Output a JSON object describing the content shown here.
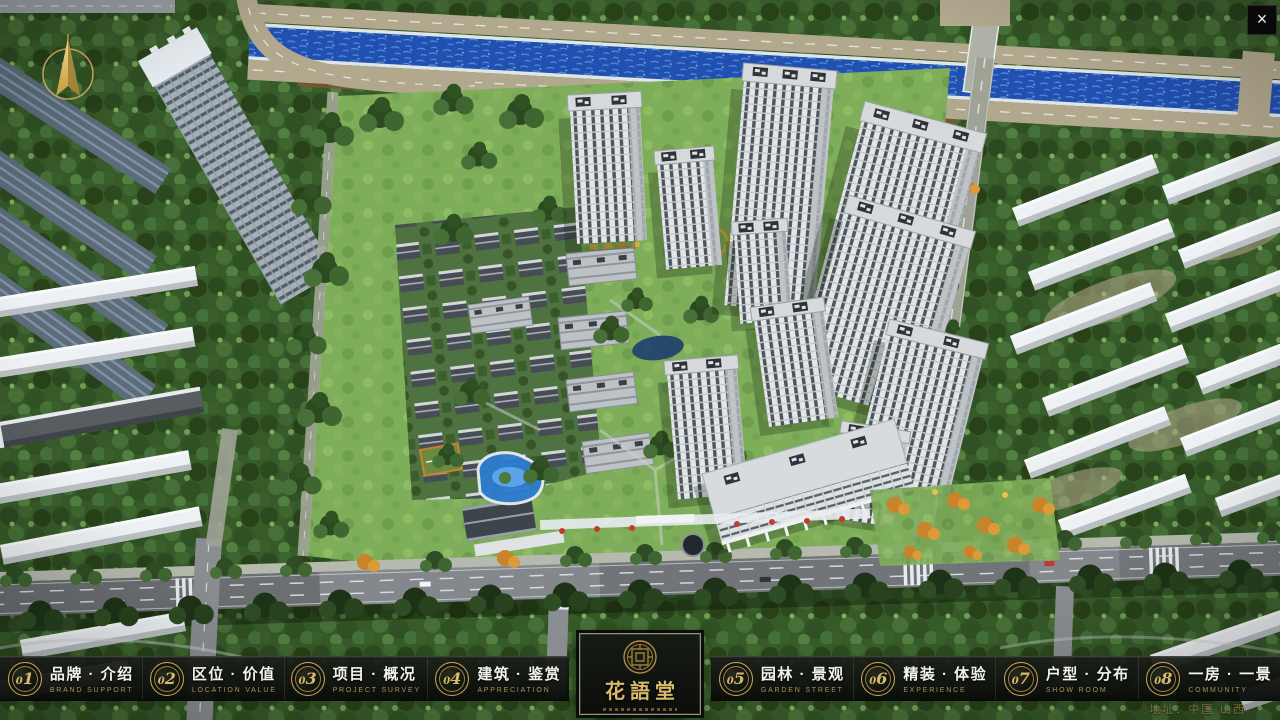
{
  "app": {
    "title_logo": "花語堂",
    "address": "地址：中国·山西",
    "close_label": "×"
  },
  "nav": {
    "items": [
      {
        "num": "01",
        "label": "品牌 · 介绍",
        "caption": "BRAND SUPPORT"
      },
      {
        "num": "02",
        "label": "区位 · 价值",
        "caption": "LOCATION VALUE"
      },
      {
        "num": "03",
        "label": "项目 · 概况",
        "caption": "PROJECT SURVEY"
      },
      {
        "num": "04",
        "label": "建筑 · 鉴赏",
        "caption": "APPRECIATION"
      },
      {
        "num": "05",
        "label": "园林 · 景观",
        "caption": "GARDEN STREET"
      },
      {
        "num": "06",
        "label": "精装 · 体验",
        "caption": "EXPERIENCE"
      },
      {
        "num": "07",
        "label": "户型 · 分布",
        "caption": "SHOW ROOM"
      },
      {
        "num": "08",
        "label": "一房 · 一景",
        "caption": "COMMUNITY"
      }
    ]
  },
  "colors": {
    "accent_gold": "#c9a85c",
    "bar_background": "#0d100d",
    "river_blue": "#2050b0"
  }
}
